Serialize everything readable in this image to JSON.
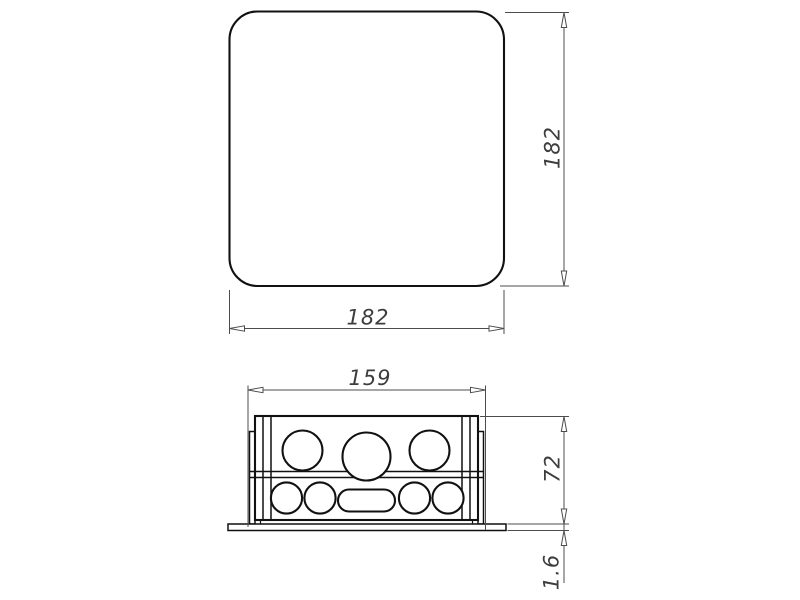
{
  "drawing": {
    "background": "#ffffff",
    "object_line_color": "#111111",
    "dimension_line_color": "#4c4c4c",
    "dimension_text_color": "#3d3d3d",
    "top_view": {
      "shape": "rounded-square-cover",
      "width_label": "182",
      "height_label": "182"
    },
    "front_view": {
      "shape": "junction-box-body-with-flange",
      "width_label": "159",
      "height_label": "72",
      "flange_thickness_label": "1.6",
      "upper_knockout_count": 3,
      "lower_knockout_count": 4,
      "lower_slot_count": 1
    }
  }
}
